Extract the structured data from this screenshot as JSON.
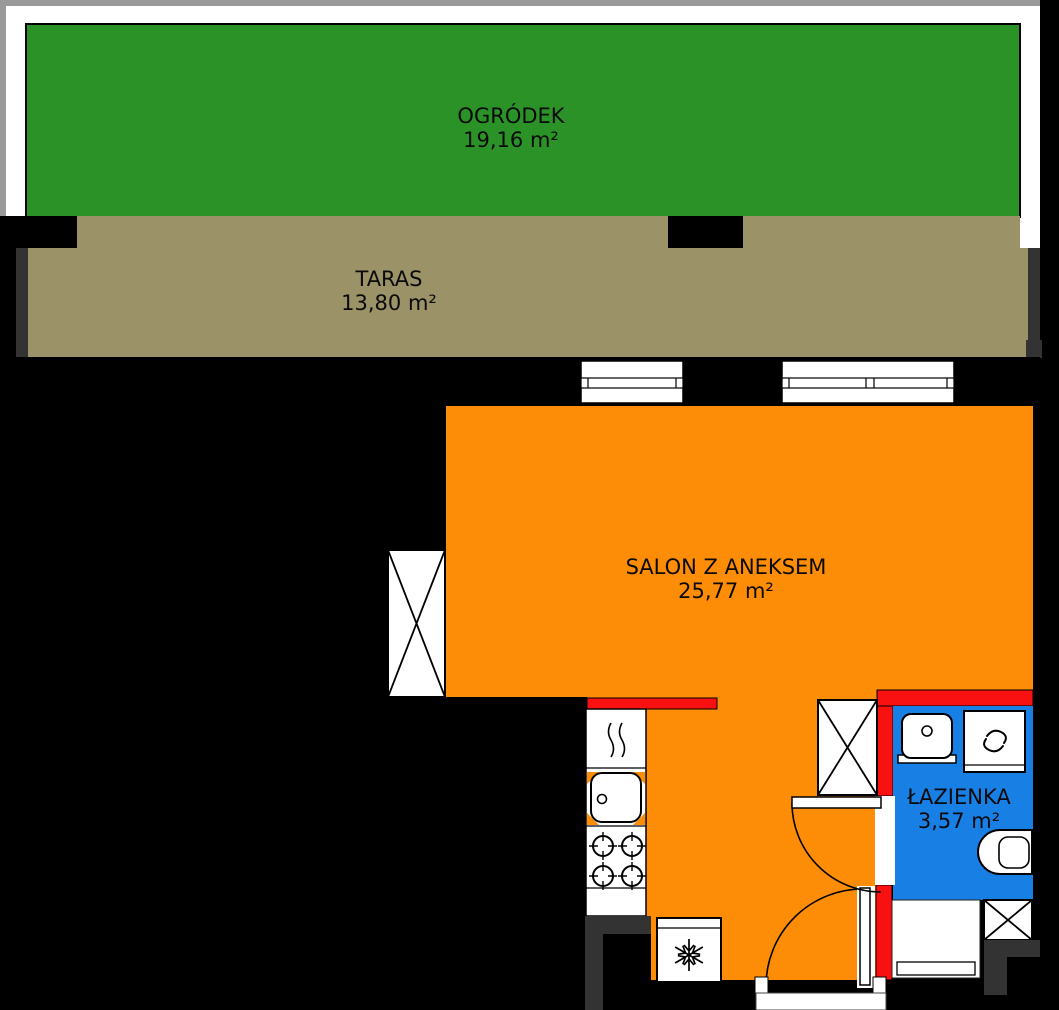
{
  "plan": {
    "type": "apartment-floor-plan",
    "rooms": {
      "garden": {
        "name": "OGRÓDEK",
        "area": "19,16 m²",
        "color": "#2B9227"
      },
      "terrace": {
        "name": "TARAS",
        "area": "13,80 m²",
        "color": "#9B9268"
      },
      "living": {
        "name": "SALON Z ANEKSEM",
        "area": "25,77 m²",
        "color": "#FD8C06"
      },
      "bathroom": {
        "name": "ŁAZIENKA",
        "area": "3,57 m²",
        "color": "#187FE5"
      }
    },
    "colors": {
      "background": "#000000",
      "wall_red": "#F91010",
      "wall_dark": "#333333",
      "wall_light": "#9A9A9A",
      "fixture_fill": "#FFFFFF",
      "outline": "#000000"
    },
    "fixtures": {
      "kitchen": [
        "cooker-hood-icon",
        "kitchen-sink-icon",
        "stove-burners-icon",
        "fridge-snowflake-icon"
      ],
      "bathroom": [
        "washbasin-icon",
        "washing-machine-icon",
        "toilet-icon"
      ],
      "openings": [
        "window",
        "window",
        "bathroom-door-swing",
        "entrance-door-swing"
      ],
      "shafts": [
        "shaft-x-box",
        "shaft-x-box",
        "shaft-x-box"
      ]
    }
  }
}
